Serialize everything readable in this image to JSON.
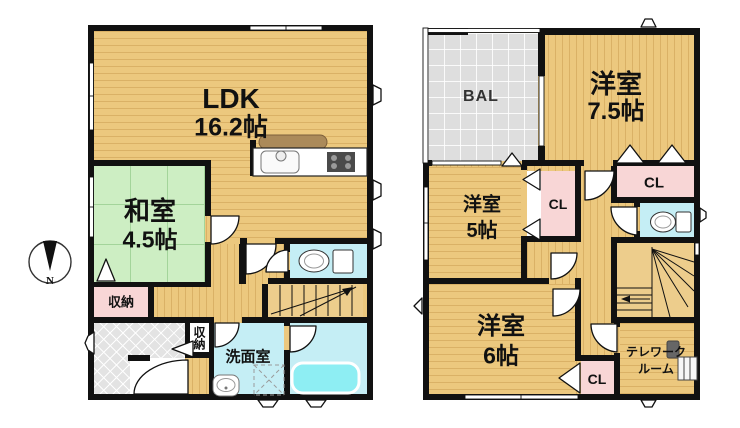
{
  "compass": {
    "north_label": "N"
  },
  "floor1": {
    "ldk": {
      "name": "LDK",
      "size": "16.2帖"
    },
    "japanese_room": {
      "name": "和室",
      "size": "4.5帖"
    },
    "closet_label": "収納",
    "entry_closet_label": "収納",
    "washroom_label": "洗面室"
  },
  "floor2": {
    "balcony_label": "BAL",
    "bedroom_75": {
      "name": "洋室",
      "size": "7.5帖"
    },
    "bedroom_5": {
      "name": "洋室",
      "size": "5帖"
    },
    "bedroom_6": {
      "name": "洋室",
      "size": "6帖"
    },
    "closet_75_label": "CL",
    "closet_5_label": "CL",
    "closet_6_label": "CL",
    "telework_room": {
      "line1": "テレワーク",
      "line2": "ルーム"
    }
  },
  "colors": {
    "wall": "#111111",
    "wood_floor": "#ecc87e",
    "tatami_green": "#cdeec3",
    "water_room_blue": "#c5eef5",
    "closet_pink": "#f8d6d6",
    "balcony_gray": "#dedede",
    "bathtub_cyan": "#8eeef3"
  }
}
